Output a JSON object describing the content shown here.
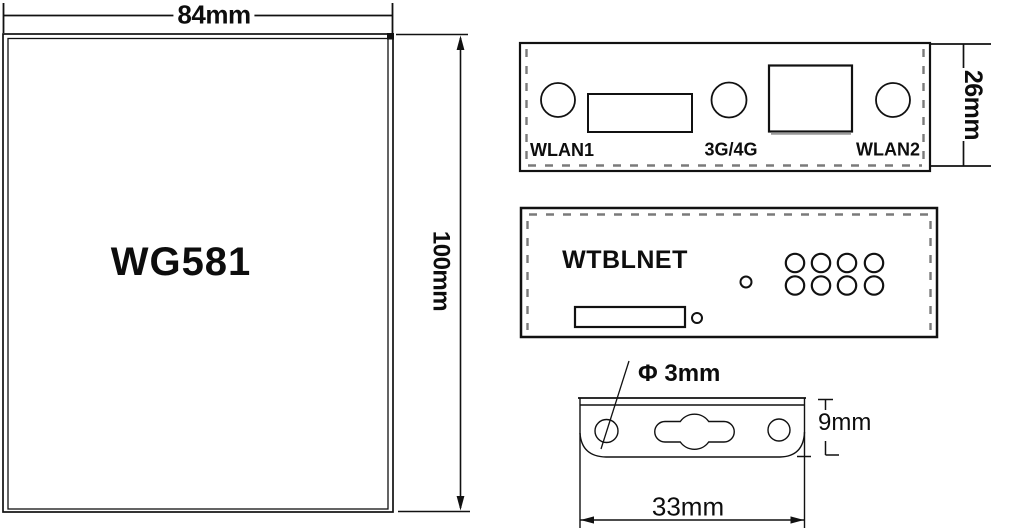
{
  "title": "WG581 dimensional drawing",
  "colors": {
    "line": "#111111",
    "dashed_line": "#7a7a7a",
    "shade_gray": "#999999",
    "background": "#ffffff",
    "text": "#0d0d0d"
  },
  "front_view": {
    "model_label": "WG581",
    "width_dim": "84mm",
    "height_dim": "100mm"
  },
  "antenna_panel": {
    "height_dim": "26mm",
    "port_labels": {
      "wlan1": "WLAN1",
      "cellular": "3G/4G",
      "wlan2": "WLAN2"
    }
  },
  "rear_panel": {
    "brand_label": "WTBLNET"
  },
  "bracket_view": {
    "hole_diameter_dim": "Φ 3mm",
    "height_dim": "9mm",
    "width_dim": "33mm"
  }
}
